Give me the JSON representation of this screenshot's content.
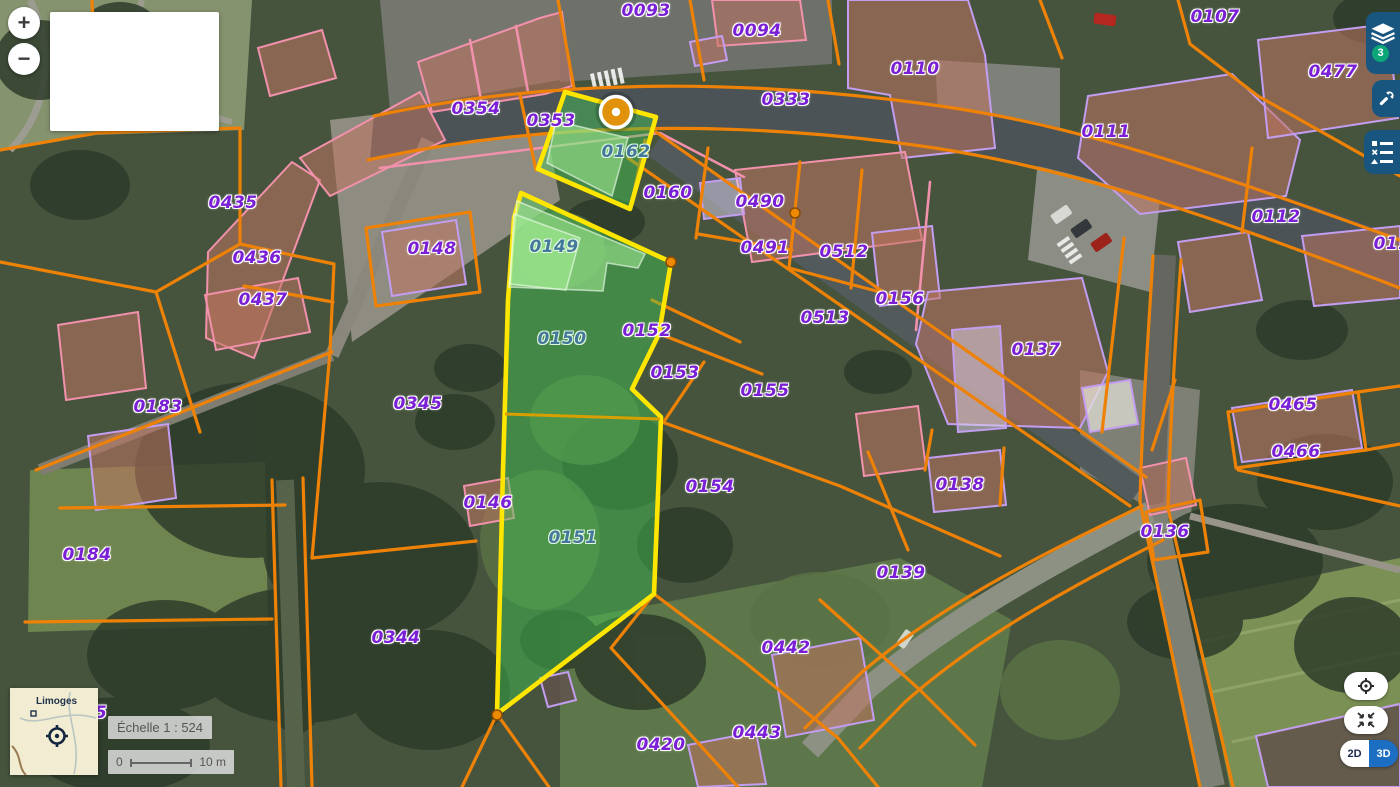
{
  "controls": {
    "zoom_in": "+",
    "zoom_out": "−",
    "layers_badge": "3",
    "view_toggle": {
      "mode_2d": "2D",
      "mode_3d": "3D",
      "active": "2D"
    }
  },
  "scale": {
    "text": "Échelle 1 : 524",
    "bar_start": "0",
    "bar_end": "10 m"
  },
  "minimap": {
    "city": "Limoges"
  },
  "map": {
    "selected_parcels": [
      "0162",
      "0149",
      "0150",
      "0151"
    ],
    "marker": {
      "x": 616,
      "y": 112
    },
    "vertices": [
      {
        "x": 795,
        "y": 213
      },
      {
        "x": 671,
        "y": 262
      },
      {
        "x": 497,
        "y": 715
      }
    ],
    "parcel_labels": [
      {
        "text": "0093",
        "x": 646,
        "y": 11,
        "variant": "normal"
      },
      {
        "text": "0094",
        "x": 757,
        "y": 31,
        "variant": "normal"
      },
      {
        "text": "0110",
        "x": 915,
        "y": 69,
        "variant": "normal"
      },
      {
        "text": "0107",
        "x": 1215,
        "y": 17,
        "variant": "normal"
      },
      {
        "text": "0477",
        "x": 1333,
        "y": 72,
        "variant": "normal"
      },
      {
        "text": "0333",
        "x": 786,
        "y": 100,
        "variant": "normal"
      },
      {
        "text": "0111",
        "x": 1106,
        "y": 132,
        "variant": "normal"
      },
      {
        "text": "0112",
        "x": 1276,
        "y": 217,
        "variant": "normal"
      },
      {
        "text": "011",
        "x": 1392,
        "y": 244,
        "variant": "normal"
      },
      {
        "text": "0354",
        "x": 476,
        "y": 109,
        "variant": "normal"
      },
      {
        "text": "0353",
        "x": 551,
        "y": 121,
        "variant": "normal"
      },
      {
        "text": "0162",
        "x": 626,
        "y": 152,
        "variant": "sel"
      },
      {
        "text": "0160",
        "x": 668,
        "y": 193,
        "variant": "normal"
      },
      {
        "text": "0490",
        "x": 760,
        "y": 202,
        "variant": "normal"
      },
      {
        "text": "0491",
        "x": 765,
        "y": 248,
        "variant": "normal"
      },
      {
        "text": "0512",
        "x": 844,
        "y": 252,
        "variant": "normal"
      },
      {
        "text": "0156",
        "x": 900,
        "y": 299,
        "variant": "normal"
      },
      {
        "text": "0513",
        "x": 825,
        "y": 318,
        "variant": "normal"
      },
      {
        "text": "0137",
        "x": 1036,
        "y": 350,
        "variant": "normal"
      },
      {
        "text": "0465",
        "x": 1293,
        "y": 405,
        "variant": "normal"
      },
      {
        "text": "0466",
        "x": 1296,
        "y": 452,
        "variant": "normal"
      },
      {
        "text": "0435",
        "x": 233,
        "y": 203,
        "variant": "normal"
      },
      {
        "text": "0436",
        "x": 257,
        "y": 258,
        "variant": "normal"
      },
      {
        "text": "0437",
        "x": 263,
        "y": 300,
        "variant": "normal"
      },
      {
        "text": "0148",
        "x": 432,
        "y": 249,
        "variant": "normal"
      },
      {
        "text": "0149",
        "x": 554,
        "y": 247,
        "variant": "sel"
      },
      {
        "text": "0150",
        "x": 562,
        "y": 339,
        "variant": "sel"
      },
      {
        "text": "0152",
        "x": 647,
        "y": 331,
        "variant": "normal"
      },
      {
        "text": "0153",
        "x": 675,
        "y": 373,
        "variant": "normal"
      },
      {
        "text": "0155",
        "x": 765,
        "y": 391,
        "variant": "normal"
      },
      {
        "text": "0345",
        "x": 418,
        "y": 404,
        "variant": "normal"
      },
      {
        "text": "0183",
        "x": 158,
        "y": 407,
        "variant": "normal"
      },
      {
        "text": "0154",
        "x": 710,
        "y": 487,
        "variant": "normal"
      },
      {
        "text": "0138",
        "x": 960,
        "y": 485,
        "variant": "normal"
      },
      {
        "text": "0146",
        "x": 488,
        "y": 503,
        "variant": "normal"
      },
      {
        "text": "0136",
        "x": 1165,
        "y": 532,
        "variant": "normal"
      },
      {
        "text": "0151",
        "x": 573,
        "y": 538,
        "variant": "sel"
      },
      {
        "text": "0184",
        "x": 87,
        "y": 555,
        "variant": "normal"
      },
      {
        "text": "0139",
        "x": 901,
        "y": 573,
        "variant": "normal"
      },
      {
        "text": "0344",
        "x": 396,
        "y": 638,
        "variant": "normal"
      },
      {
        "text": "0442",
        "x": 786,
        "y": 648,
        "variant": "normal"
      },
      {
        "text": "0420",
        "x": 661,
        "y": 745,
        "variant": "normal"
      },
      {
        "text": "0443",
        "x": 757,
        "y": 733,
        "variant": "normal"
      },
      {
        "text": "5",
        "x": 101,
        "y": 713,
        "variant": "normal"
      }
    ]
  },
  "theme": {
    "orange": "#ee8206",
    "pink": "#f191ac",
    "building-stroke": "#c39df0",
    "selection-yellow": "#ffe600",
    "selection-fill": "rgba(66,200,84,0.45)",
    "label-purple": "#7a1fd6",
    "label-selected": "#44789b",
    "toolbar-blue": "#19567f",
    "badge-green": "#0ca678",
    "blue-3d": "#1b6ec2",
    "marker-orange": "#e0930a"
  }
}
